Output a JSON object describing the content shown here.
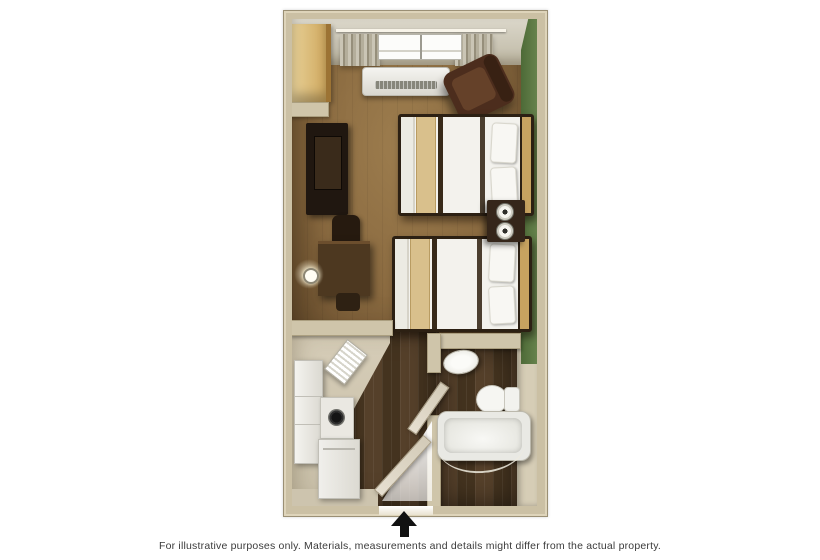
{
  "caption": "For illustrative purposes only.  Materials, measurements and details might differ from the actual property.",
  "entrance": {
    "icon": "up-arrow"
  },
  "colors": {
    "background": "#ffffff",
    "wall": "#cbc0a4",
    "wall_edge": "#9a8f74",
    "floor_wood_light": "#8a6a40",
    "floor_wood_dark": "#4a3624",
    "accent_wall_green": "#5e7a44",
    "furniture_dark_wood": "#35261a",
    "bedding_white": "#f3f2ed",
    "bedding_tan": "#d9c08c",
    "fixture_white": "#f0efeb",
    "caption_text": "#3b3b3b",
    "entrance_arrow": "#111111"
  },
  "floorplan": {
    "type": "studio-suite-two-double-beds",
    "rooms": [
      "living-sleeping-area",
      "kitchenette",
      "hallway",
      "bathroom",
      "closet"
    ],
    "furniture": [
      "window",
      "curtains",
      "ac-heater-unit",
      "closet",
      "tv-console",
      "desk",
      "desk-chair",
      "wall-sconce",
      "armchair",
      "double-bed-1",
      "double-bed-2",
      "nightstand",
      "table-lamps",
      "refrigerator",
      "stove",
      "kitchen-sink",
      "dishwasher",
      "bathroom-sink",
      "toilet",
      "bathtub",
      "shower-curtain-rod",
      "entry-door",
      "bathroom-door"
    ]
  }
}
